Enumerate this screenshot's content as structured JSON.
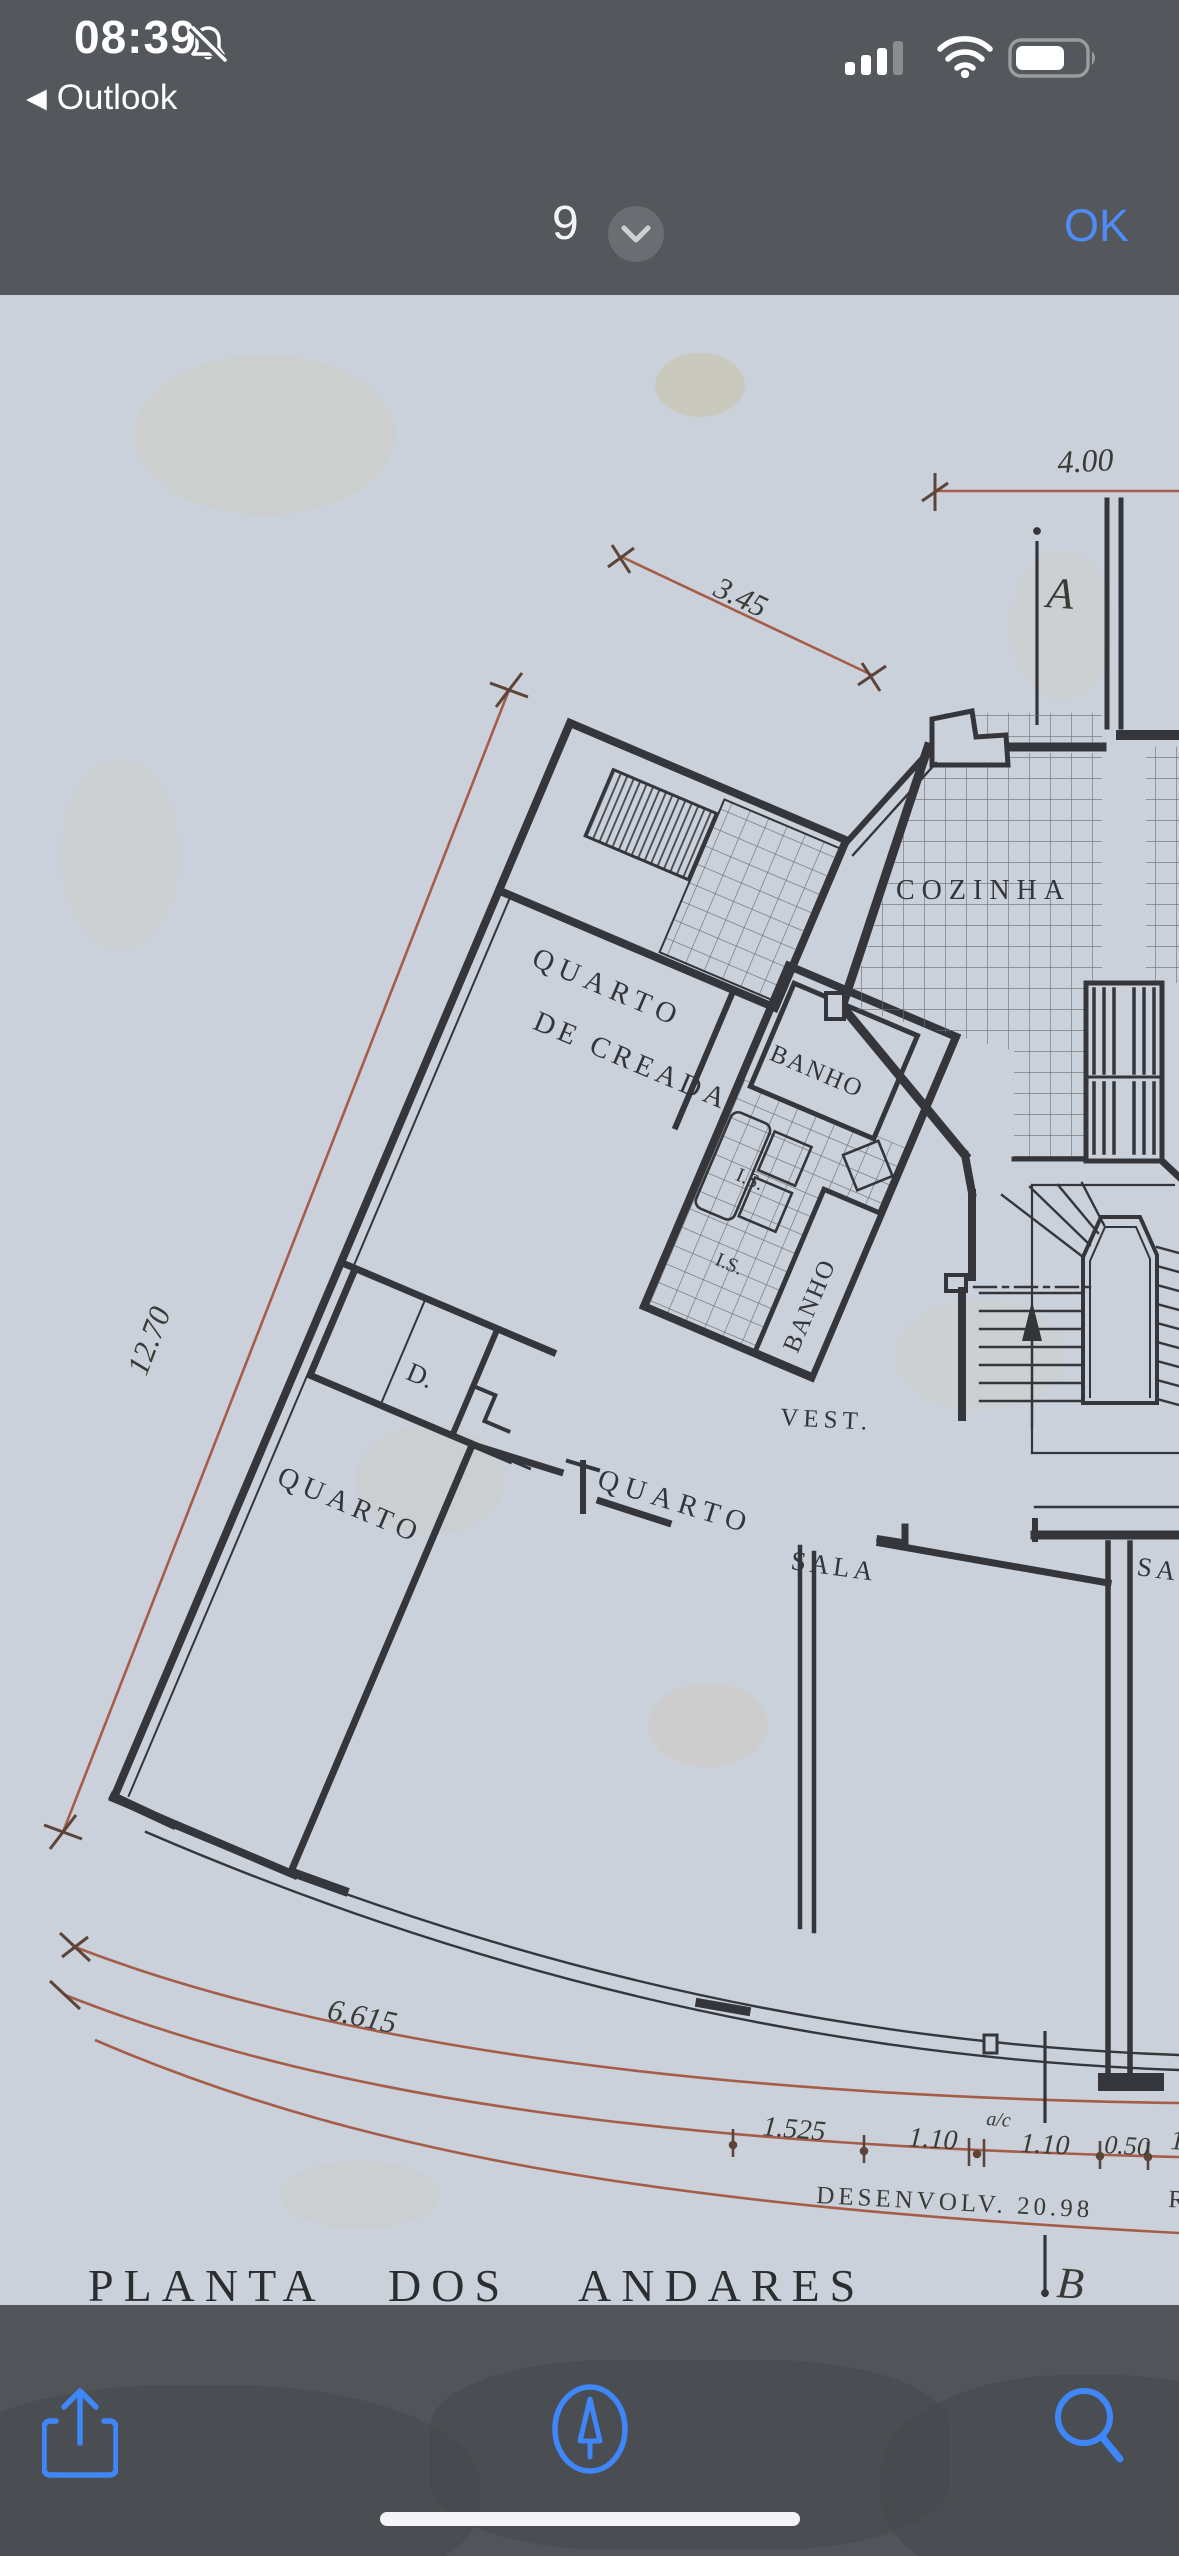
{
  "status_bar": {
    "time": "08:39",
    "back_chevron": "◀",
    "back_app": "Outlook",
    "icons": [
      "bell-slash-icon",
      "cellular-signal-icon",
      "wifi-icon",
      "battery-icon"
    ]
  },
  "nav_bar": {
    "page_indicator": "9",
    "ok_label": "OK"
  },
  "floor_plan": {
    "title_words": [
      "PLANTA",
      "DOS",
      "ANDARES"
    ],
    "rooms": {
      "maid_room_line1": "QUARTO",
      "maid_room_line2": "DE CREADA",
      "bath_upper": "BANHO",
      "bath_lower": "BANHO",
      "wc_upper": "I.S.",
      "wc_lower": "I.S.",
      "kitchen": "COZINHA",
      "closet": "D.",
      "bedroom_left": "QUARTO",
      "bedroom_middle": "QUARTO",
      "vestibule": "VEST.",
      "living_room": "SALA",
      "living_room_partial": "SA"
    },
    "dimensions": {
      "top": "4.00",
      "upper_diagonal": "3.45",
      "left_diagonal": "12.70",
      "bottom_left": "6.615",
      "seg1": "1.525",
      "seg2": "1.10",
      "seg2_note": "a/c",
      "seg3": "1.10",
      "seg4": "0.50",
      "seg5_partial": "1",
      "development": "DESENVOLV. 20.98",
      "development_partial_right": "R"
    },
    "section_markers": {
      "top": "A",
      "bottom": "B"
    }
  },
  "toolbar": {
    "icons": [
      "share-icon",
      "markup-compass-icon",
      "search-icon"
    ]
  },
  "colors": {
    "chrome_bg": "#54575b",
    "accent_blue": "#4e8cf7",
    "paper": "#cbd1da",
    "ink": "#35363b",
    "dimension_red": "#a55d49"
  }
}
